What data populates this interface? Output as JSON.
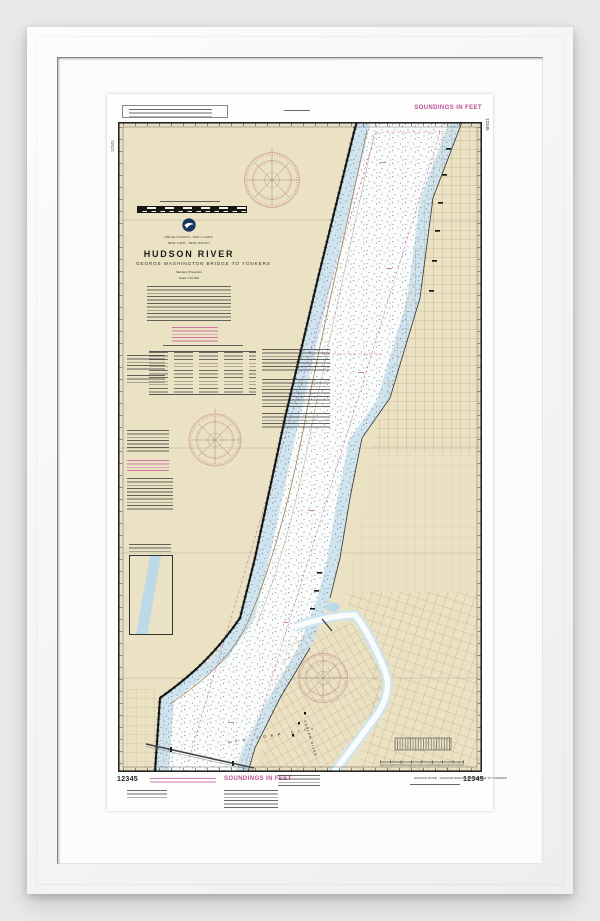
{
  "artwork": {
    "type": "framed NOAA nautical chart print",
    "chart_number": "12345",
    "soundings_label": "SOUNDINGS IN FEET",
    "title_block": {
      "country": "UNITED STATES - EAST COAST",
      "region": "NEW YORK - NEW JERSEY",
      "title": "HUDSON RIVER",
      "subtitle": "GEORGE WASHINGTON BRIDGE TO YONKERS",
      "projection": "Mercator Projection",
      "scale": "Scale 1:10,000"
    },
    "map_labels": {
      "city": "NEW YORK CITY",
      "river": "HARLEM RIVER"
    },
    "footer": {
      "title_line": "HUDSON RIVER - GEORGE WASHINGTON BRIDGE TO YONKERS"
    },
    "colors": {
      "background": "#e9e9ea",
      "frame": "#f7f7f8",
      "mat": "#fcfcfd",
      "paper": "#fdfdfc",
      "land_tan": "#ebe2c4",
      "shallow_water": "#cfe4ee",
      "channel_white": "#fafbfb",
      "chart_magenta": "#bb4f97",
      "compass_rose": "#c0797e"
    }
  }
}
